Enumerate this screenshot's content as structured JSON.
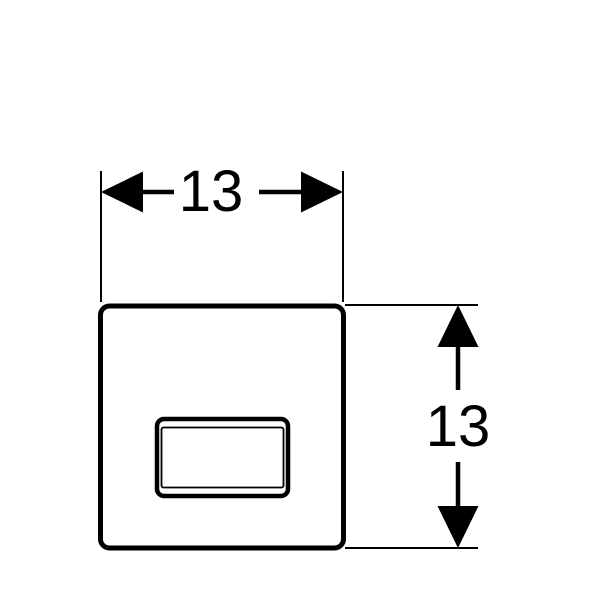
{
  "diagram": {
    "type": "technical-dimension-drawing",
    "colors": {
      "line": "#000000",
      "background": "#ffffff"
    },
    "dimensions": {
      "width": {
        "label": "13"
      },
      "height": {
        "label": "13"
      }
    }
  }
}
